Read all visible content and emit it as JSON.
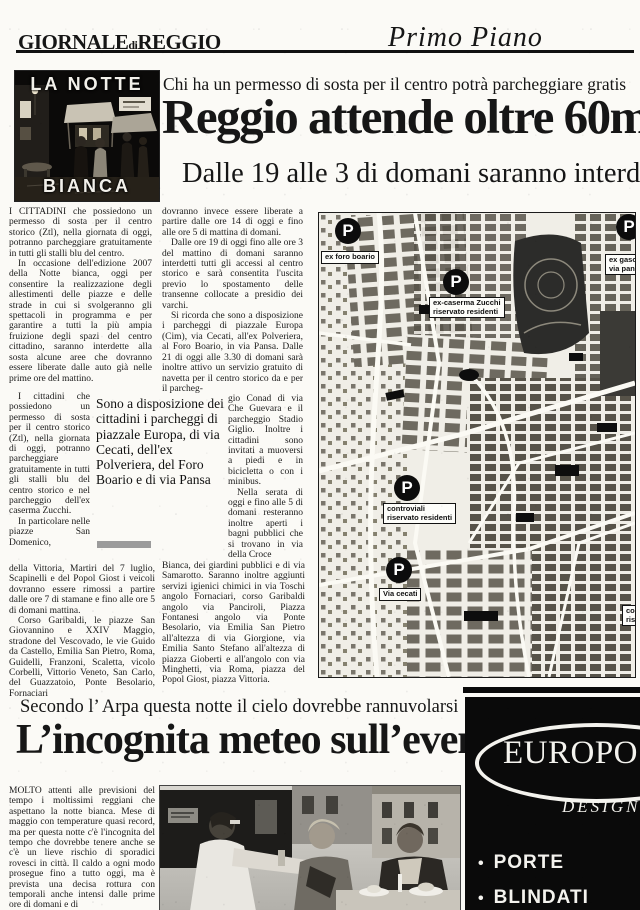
{
  "masthead": {
    "title_1": "GIORNALE",
    "title_2": "di",
    "title_3": "REGGIO",
    "section": "Primo Piano"
  },
  "photo_box": {
    "top_label": "LA NOTTE",
    "bottom_label": "BIANCA"
  },
  "main_article": {
    "kicker": "Chi ha un permesso di sosta per il centro potrà parcheggiare gratis",
    "headline": "Reggio attende oltre 60m",
    "subhead": "Dalle 19 alle 3 di domani saranno interde",
    "col1_a": "I CITTADINI che possiedono un permesso di sosta per il centro storico (Ztl), nella giornata di oggi, potranno parcheggiare gratuitamente in tutti gli stalli blu del centro.",
    "col1_b": "In occasione dell'edizione 2007 della Notte bianca, oggi per consentire la realizzazione degli allestimenti delle piazze e delle strade in cui si svolgeranno gli spettacoli in programma e per garantire a tutti la più ampia fruizione degli spazi del centro cittadino, saranno interdette alla sosta alcune aree che dovranno essere liberate dalle auto già nelle prime ore del mattino.",
    "col1_narrow_1": "I cittadini che possiedono un permesso di sosta per il centro storico (Ztl), nella giornata di oggi, potranno parcheggiare gratuitamente in tutti gli stalli blu del centro storico e nel parcheggio dell'ex caserma Zucchi.",
    "col1_narrow_2": "In particolare nelle piazze San Domenico,",
    "pull_quote": "Sono a disposizione dei cittadini i parcheggi di piazzale Europa, di via Cecati, dell'ex Polveriera, del Foro Boario e di via Pansa",
    "col1_c": "della Vittoria, Martiri del 7 luglio, Scapinelli e del Popol Giost i veicoli dovranno essere rimossi a partire dalle ore 7 di stamane e fino alle ore 5 di domani mattina.",
    "col1_d": "Corso Garibaldi, le piazze San Giovannino e XXIV Maggio, stradone del Vescovado, le vie Guido da Castello, Emilia San Pietro, Roma, Guidelli, Franzoni, Scaletta, vicolo Corbelli, Vittorio Veneto, San Carlo, del Guazzatoio, Ponte Besolario, Fornaciari",
    "col2_a1": "dovranno invece essere liberate a partire dalle ore 14 di oggi e fino alle ore 5 di mattina di domani.",
    "col2_a2": "Dalle ore 19 di oggi fino alle ore 3 del mattino di domani saranno interdetti tutti gli accessi al centro storico e sarà consentita l'uscita previo lo spostamento delle transenne collocate a presidio dei varchi.",
    "col2_a3": "Si ricorda che sono a disposizione i parcheggi di piazzale Europa (Cim), via Cecati, all'ex Polveriera, al Foro Boario, in via Pansa. Dalle 21 di oggi alle 3.30 di domani sarà inoltre attivo un servizio gratuito di navetta per il centro storico da e per il parcheg-",
    "col2_narrow_1": "gio Conad di via Che Guevara e il parcheggio Stadio Giglio. Inoltre i cittadini sono invitati a muoversi a piedi e in bicicletta o con i minibus.",
    "col2_narrow_2": "Nella serata di oggi e fino alle 5 di domani resteranno inoltre aperti i bagni pubblici che si trovano in via della Croce",
    "col2_b": "Bianca, dei giardini pubblici e di via Samarotto. Saranno inoltre aggiunti servizi igienici chimici in via Toschi angolo Fornaciari, corso Garibaldi angolo via Panciroli, Piazza Fontanesi angolo via Ponte Besolario, via Emilia San Pietro all'altezza di via Giorgione, via Emilia Santo Stefano all'altezza di piazza Gioberti e all'angolo con via Minghetti, via Roma, piazza del Popol Giost, piazza Vittoria."
  },
  "map": {
    "marker_letter": "P",
    "markers": [
      {
        "label_lines": [
          "ex foro boario",
          ""
        ]
      },
      {
        "label_lines": [
          "ex-caserma Zucchi",
          "riservato residenti"
        ]
      },
      {
        "label_lines": [
          "ex gaso",
          "via pans"
        ]
      },
      {
        "label_lines": [
          "controviali",
          "riservato residenti"
        ]
      },
      {
        "label_lines": [
          "Via cecati",
          ""
        ]
      },
      {
        "label_lines": [
          "con",
          "rise"
        ]
      }
    ]
  },
  "weather_article": {
    "kicker": "Secondo l’ Arpa questa notte il cielo dovrebbe rannuvolarsi",
    "headline": "L’incognita meteo sull’evento",
    "body": "MOLTO attenti alle previsioni del tempo i moltissimi reggiani che aspettano la notte bianca. Mese di maggio con temperature quasi record, ma per questa notte c'è l'incognita del tempo che dovrebbe tenere anche se c'è un lieve rischio di sporadici rovesci in città. Il caldo a ogni modo prosegue fino a tutto oggi, ma è prevista una decisa rottura con temporali anche intensi dalle prime ore di domani e di"
  },
  "ad": {
    "brand": "EUROPO",
    "sub_brand": "DESIGN",
    "bullet_dot": "•",
    "bullets": [
      "PORTE",
      "BLINDATI"
    ]
  },
  "colors": {
    "ink": "#1a1a1a",
    "paper": "#fbfaf6"
  }
}
